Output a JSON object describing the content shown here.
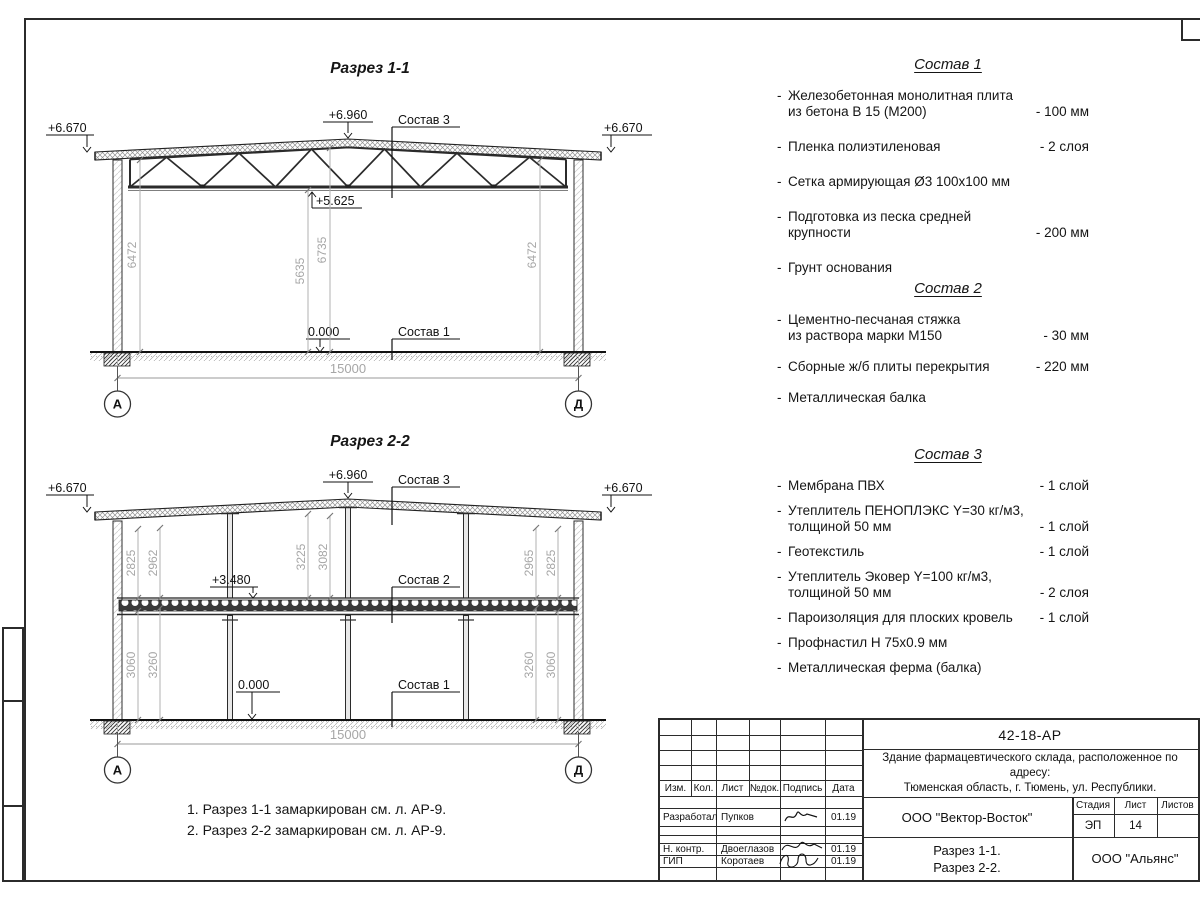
{
  "ui": {
    "bullet": "-"
  },
  "sections": [
    {
      "title": "Разрез 1-1",
      "elev_left": "+6.670",
      "elev_right": "+6.670",
      "elev_peak": "+6.960",
      "elev_chord": "+5.625",
      "elev_floor": "0.000",
      "label_roof": "Состав 3",
      "label_floor": "Состав 1",
      "dim_left": "6472",
      "dim_mid1": "5635",
      "dim_mid2": "6735",
      "dim_right": "6472",
      "span": "15000",
      "axis_left": "А",
      "axis_right": "Д"
    },
    {
      "title": "Разрез 2-2",
      "elev_left": "+6.670",
      "elev_right": "+6.670",
      "elev_peak": "+6.960",
      "elev_mid": "+3.480",
      "elev_floor": "0.000",
      "label_roof": "Состав 3",
      "label_mid": "Состав 2",
      "label_floor": "Состав 1",
      "dim_ul_outer": "2825",
      "dim_ul_inner": "2962",
      "dim_um_left": "3225",
      "dim_um_right": "3082",
      "dim_ur_inner": "2965",
      "dim_ur_outer": "2825",
      "dim_ll_outer": "3060",
      "dim_ll_inner": "3260",
      "dim_lr_inner": "3260",
      "dim_lr_outer": "3060",
      "span": "15000",
      "axis_left": "А",
      "axis_right": "Д"
    }
  ],
  "compositions": [
    {
      "title": "Состав 1",
      "items": [
        {
          "line1": "Железобетонная  монолитная плита",
          "line2": "из бетона В 15 (М200)",
          "value": "- 100 мм"
        },
        {
          "line1": "Пленка полиэтиленовая",
          "value": "-  2 слоя"
        },
        {
          "line1": "Сетка армирующая Ø3 100х100 мм",
          "value": ""
        },
        {
          "line1": "Подготовка из песка средней",
          "line2": "крупности",
          "value": "- 200 мм"
        },
        {
          "line1": "Грунт основания",
          "value": ""
        }
      ]
    },
    {
      "title": "Состав 2",
      "items": [
        {
          "line1": "Цементно-песчаная стяжка",
          "line2": "из раствора марки М150",
          "value": "- 30 мм"
        },
        {
          "line1": "Сборные ж/б плиты перекрытия",
          "value": "- 220 мм"
        },
        {
          "line1": "Металлическая балка",
          "value": ""
        }
      ]
    },
    {
      "title": "Состав 3",
      "items": [
        {
          "line1": "Мембрана ПВХ",
          "value": "- 1 слой"
        },
        {
          "line1": "Утеплитель ПЕНОПЛЭКС Y=30 кг/м3,",
          "line2": "толщиной 50 мм",
          "value": "- 1 слой"
        },
        {
          "line1": "Геотекстиль",
          "value": "- 1 слой"
        },
        {
          "line1": "Утеплитель Эковер Y=100 кг/м3,",
          "line2": "толщиной 50 мм",
          "value": "- 2 слоя"
        },
        {
          "line1": "Пароизоляция для плоских кровель",
          "value": "- 1 слой"
        },
        {
          "line1": "Профнастил Н 75х0.9 мм",
          "value": ""
        },
        {
          "line1": "Металлическая ферма (балка)",
          "value": ""
        }
      ]
    }
  ],
  "notes": {
    "line1": "1. Разрез 1-1 замаркирован см. л. АР-9.",
    "line2": "2. Разрез 2-2 замаркирован см. л. АР-9."
  },
  "titleblock": {
    "code": "42-18-АР",
    "project_line1": "Здание фармацевтического склада, расположенное по адресу:",
    "project_line2": "Тюменская область, г. Тюмень, ул. Республики.",
    "col_izm": "Изм.",
    "col_kol": "Кол.",
    "col_list": "Лист",
    "col_ndok": "№док.",
    "col_podpis": "Подпись",
    "col_data": "Дата",
    "rows": [
      {
        "role": "Разработал",
        "name": "Пупков",
        "date": "01.19"
      },
      {
        "role": "Н. контр.",
        "name": "Двоеглазов",
        "date": "01.19"
      },
      {
        "role": "ГИП",
        "name": "Коротаев",
        "date": "01.19"
      }
    ],
    "company": "ООО \"Вектор-Восток\"",
    "stage_label": "Стадия",
    "sheet_label": "Лист",
    "sheets_label": "Листов",
    "stage": "ЭП",
    "sheet_no": "14",
    "sheets_total": "",
    "title_line1": "Разрез 1-1.",
    "title_line2": "Разрез 2-2.",
    "org": "ООО \"Альянс\""
  }
}
